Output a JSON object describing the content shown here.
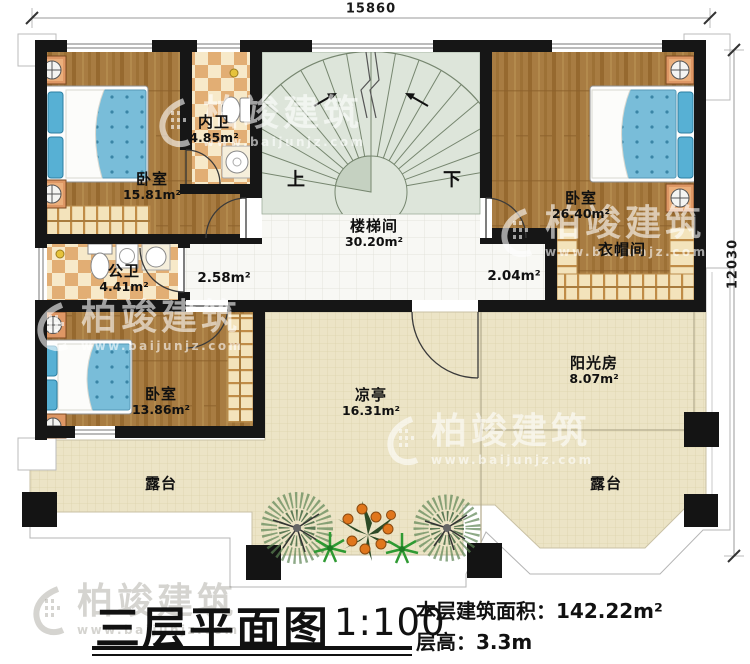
{
  "watermark": {
    "brand": "柏竣建筑",
    "url": "www.baijunjz.com"
  },
  "dimensions": {
    "top": "15860",
    "right": "12030"
  },
  "stairs": {
    "up_label": "上",
    "down_label": "下"
  },
  "rooms": {
    "bedroom1": {
      "name": "卧室",
      "area": "15.81m²"
    },
    "inner_bath": {
      "name": "内卫",
      "area": "4.85m²"
    },
    "stair_hall": {
      "name": "楼梯间",
      "area": "30.20m²"
    },
    "bedroom2": {
      "name": "卧室",
      "area": "26.40m²"
    },
    "cloakroom": {
      "name": "衣帽间"
    },
    "public_bath": {
      "name": "公卫",
      "area": "4.41m²"
    },
    "hall_left": {
      "area": "2.58m²"
    },
    "hall_right": {
      "area": "2.04m²"
    },
    "bedroom3": {
      "name": "卧室",
      "area": "13.86m²"
    },
    "pavilion": {
      "name": "凉亭",
      "area": "16.31m²"
    },
    "sunroom": {
      "name": "阳光房",
      "area": "8.07m²"
    },
    "terrace_left": {
      "name": "露台"
    },
    "terrace_right": {
      "name": "露台"
    }
  },
  "title_block": {
    "title": "三层平面图",
    "scale": "1:100",
    "floor_area_label": "本层建筑面积：",
    "floor_area_value": "142.22m²",
    "floor_height_label": "层高：",
    "floor_height_value": "3.3m"
  }
}
